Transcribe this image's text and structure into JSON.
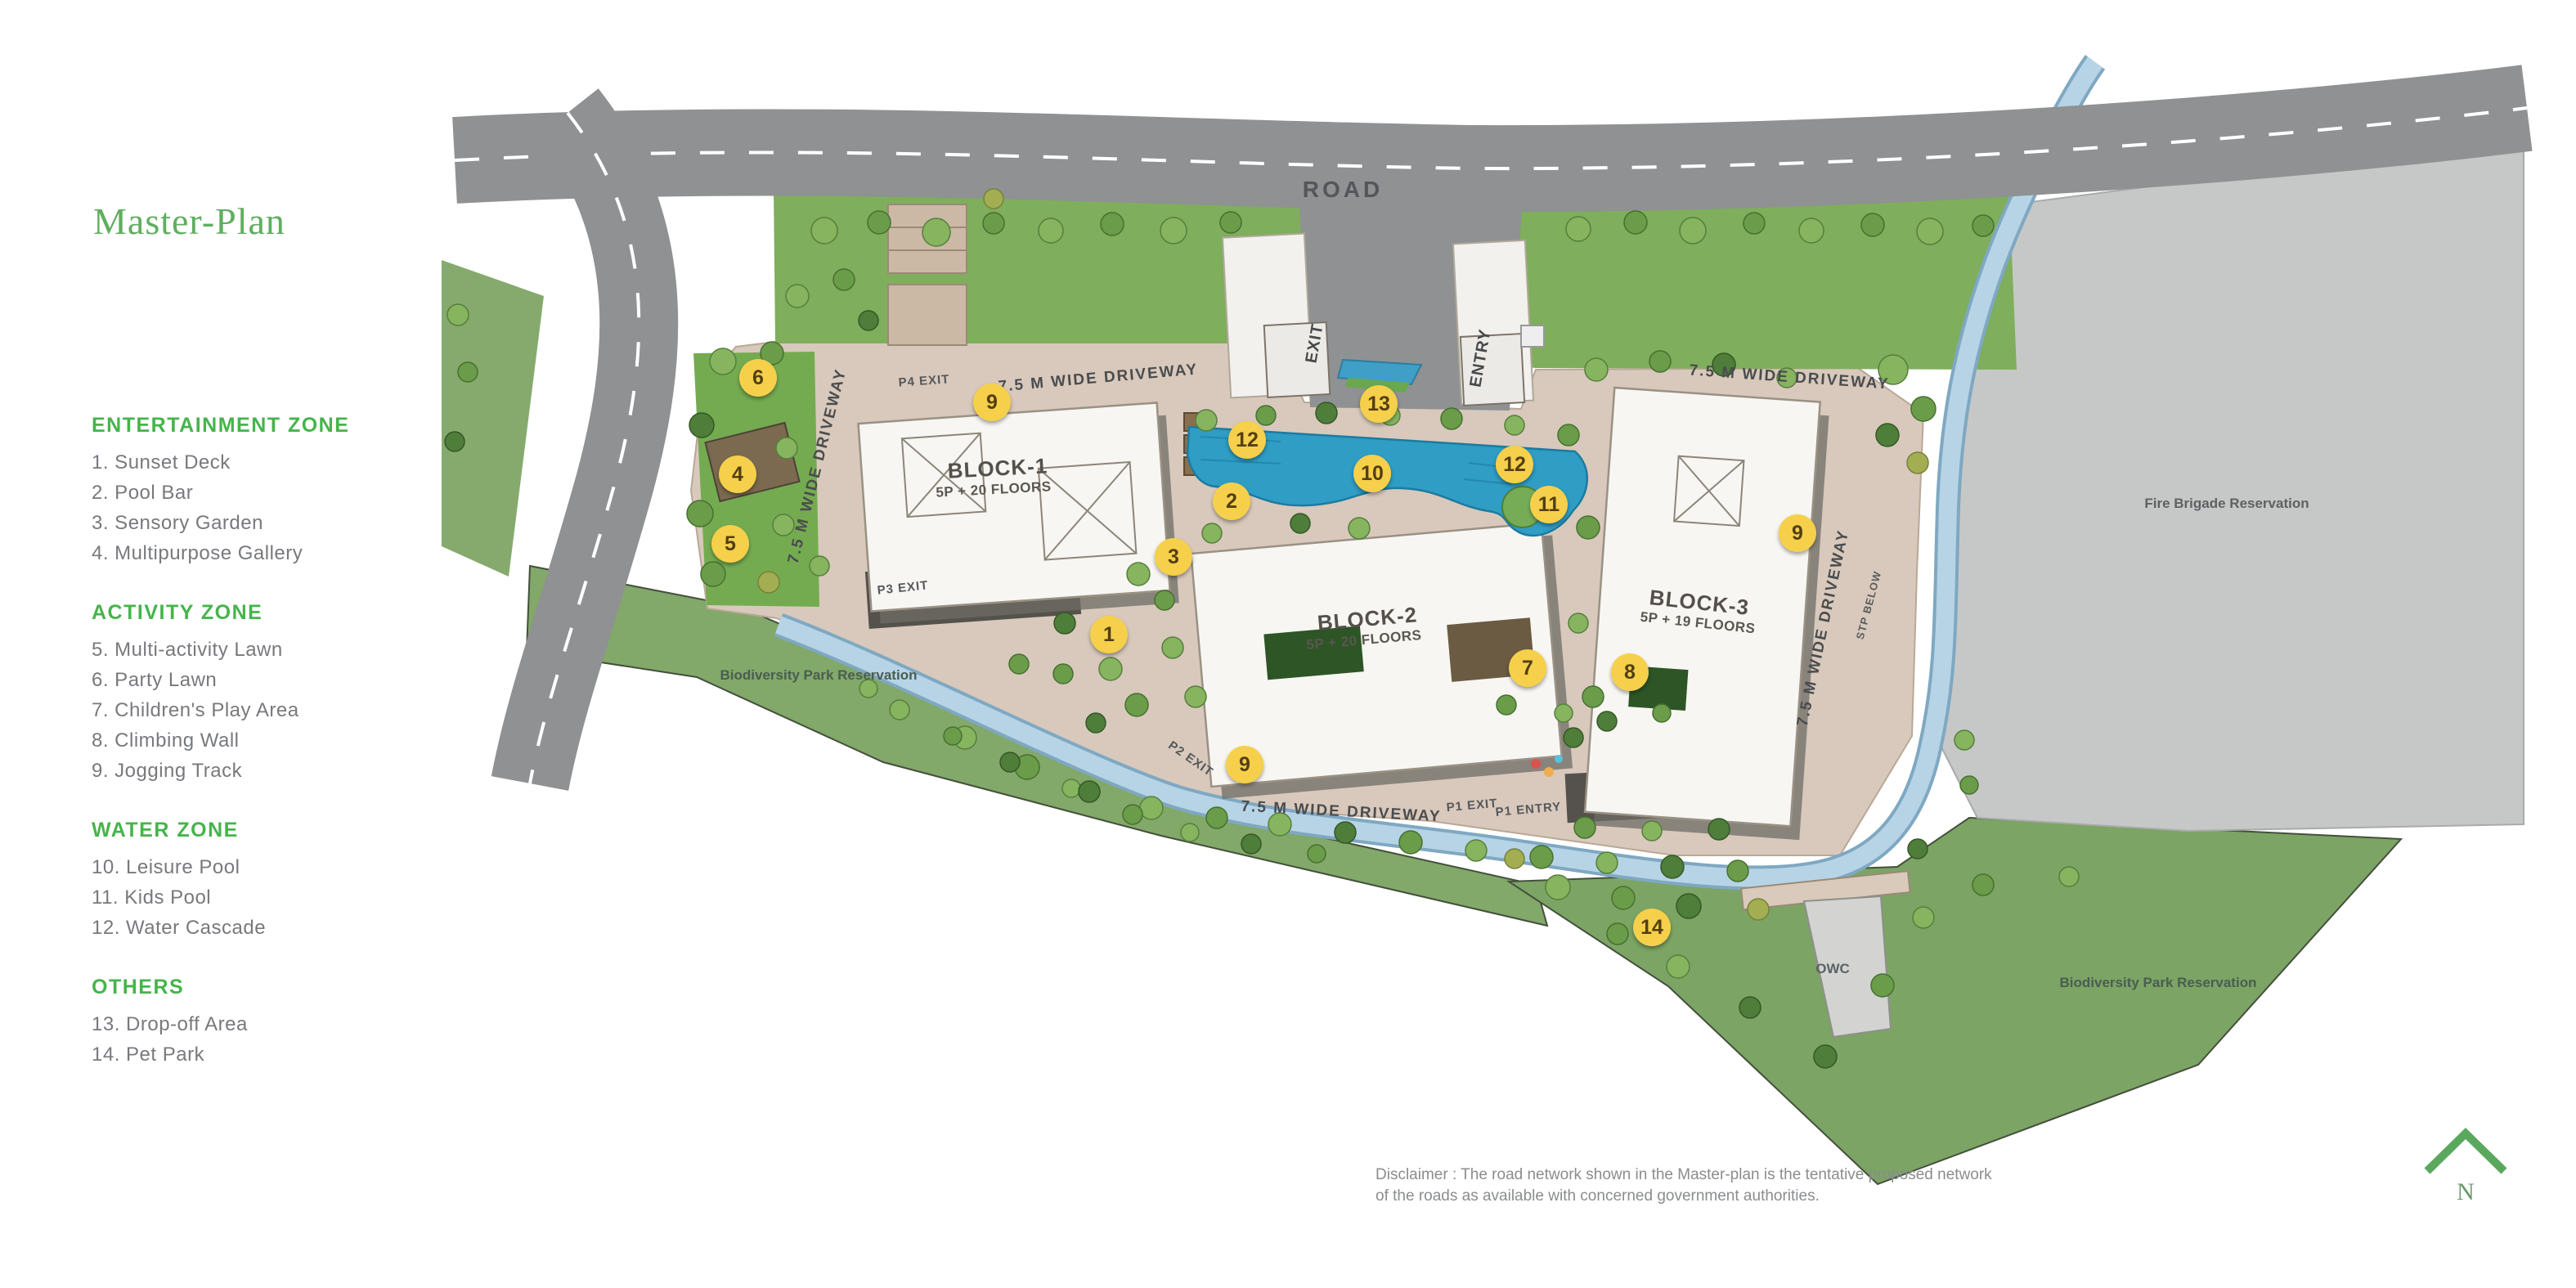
{
  "page": {
    "title": "Master-Plan",
    "disclaimer": {
      "line1": "Disclaimer : The road network shown in the Master-plan is the tentative proposed network",
      "line2": "of the roads as available with concerned government authorities."
    },
    "north_label": "N"
  },
  "legend": {
    "sections": [
      {
        "heading": "ENTERTAINMENT ZONE",
        "items": [
          "1. Sunset Deck",
          "2. Pool Bar",
          "3. Sensory Garden",
          "4. Multipurpose Gallery"
        ]
      },
      {
        "heading": "ACTIVITY ZONE",
        "items": [
          "5. Multi-activity Lawn",
          "6. Party Lawn",
          "7. Children's Play Area",
          "8. Climbing Wall",
          "9. Jogging Track"
        ]
      },
      {
        "heading": "WATER ZONE",
        "items": [
          "10. Leisure Pool",
          "11. Kids Pool",
          "12. Water Cascade"
        ]
      },
      {
        "heading": "OTHERS",
        "items": [
          "13. Drop-off Area",
          "14. Pet Park"
        ]
      }
    ]
  },
  "map": {
    "labels": {
      "road": "ROAD",
      "exit": "EXIT",
      "entry": "ENTRY",
      "driveway": "7.5 M WIDE DRIVEWAY",
      "p4_exit": "P4 EXIT",
      "p3_exit": "P3 EXIT",
      "p2_exit": "P2 EXIT",
      "p1_exit": "P1 EXIT",
      "p1_entry": "P1 ENTRY",
      "stp_below": "STP BELOW",
      "owc": "OWC",
      "fire_brigade": "Fire Brigade Reservation",
      "biodiversity_park": "Biodiversity Park Reservation"
    },
    "blocks": [
      {
        "name": "BLOCK-1",
        "floors": "5P + 20 FLOORS"
      },
      {
        "name": "BLOCK-2",
        "floors": "5P + 20 FLOORS"
      },
      {
        "name": "BLOCK-3",
        "floors": "5P + 19 FLOORS"
      }
    ],
    "markers": [
      {
        "label": "1"
      },
      {
        "label": "2"
      },
      {
        "label": "3"
      },
      {
        "label": "4"
      },
      {
        "label": "5"
      },
      {
        "label": "6"
      },
      {
        "label": "7"
      },
      {
        "label": "8"
      },
      {
        "label": "9"
      },
      {
        "label": "9"
      },
      {
        "label": "9"
      },
      {
        "label": "10"
      },
      {
        "label": "11"
      },
      {
        "label": "12"
      },
      {
        "label": "12"
      },
      {
        "label": "13"
      },
      {
        "label": "14"
      }
    ]
  },
  "colors": {
    "title_green": "#5fae5f",
    "heading_green": "#46b44b",
    "marker_yellow": "#f6d04b",
    "pool_blue": "#2f9dc4",
    "canal_blue": "#b7d4e6",
    "road_gray": "#8f9192",
    "parcel_tan": "#d8c9bc",
    "park_green": "#82a86a"
  }
}
